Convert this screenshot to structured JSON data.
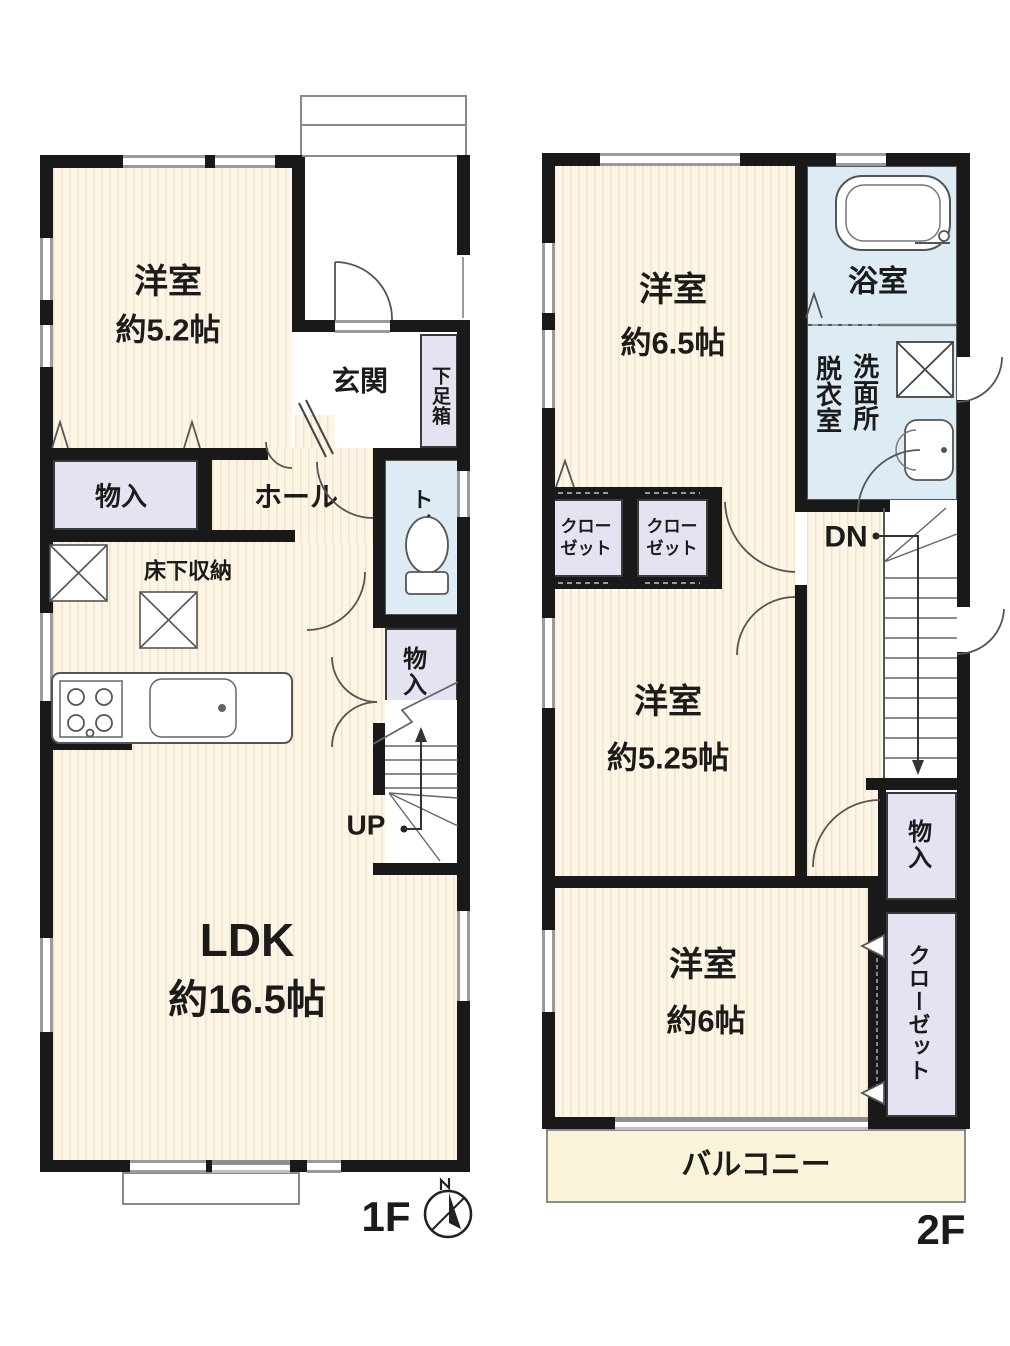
{
  "floor1": {
    "floor_label": "1F",
    "western_room": {
      "name": "洋室",
      "area": "約5.2帖"
    },
    "ldk": {
      "name": "LDK",
      "area": "約16.5帖"
    },
    "genkan": "玄関",
    "shoe_box": "下足箱",
    "storage_front": "物入",
    "hall": "ホール",
    "toilet": "トイレ",
    "underfloor_storage": "床下収納",
    "storage_stair": "物入",
    "stairs_up": "UP"
  },
  "floor2": {
    "floor_label": "2F",
    "western_room_65": {
      "name": "洋室",
      "area": "約6.5帖"
    },
    "western_room_525": {
      "name": "洋室",
      "area": "約5.25帖"
    },
    "western_room_6": {
      "name": "洋室",
      "area": "約6帖"
    },
    "bath": "浴室",
    "washroom": {
      "right_column": "洗面所",
      "left_column": "脱衣室"
    },
    "closet_left": {
      "line1": "クロー",
      "line2": "ゼット"
    },
    "closet_right": {
      "line1": "クロー",
      "line2": "ゼット"
    },
    "storage": "物入",
    "closet_tall": "クローゼット",
    "stairs_down": "DN",
    "balcony": "バルコニー"
  },
  "colors": {
    "wall": "#191919",
    "floor_base": "#fdf5e5",
    "floor_stripe": "#f2e4c8",
    "storage_fill": "#e4e3f1",
    "wet_area_fill": "#ddebf5",
    "balcony_fill": "#f9f3d9",
    "line": "#555555"
  },
  "icons": {
    "compass": "compass-north-icon",
    "bathtub": "bathtub-icon",
    "toilet": "toilet-icon",
    "washer": "washer-hatch-icon",
    "stove": "stove-icon",
    "kitchen": "kitchen-counter-icon",
    "stairs_up": "stairs-up-icon",
    "stairs_down": "stairs-down-icon"
  }
}
